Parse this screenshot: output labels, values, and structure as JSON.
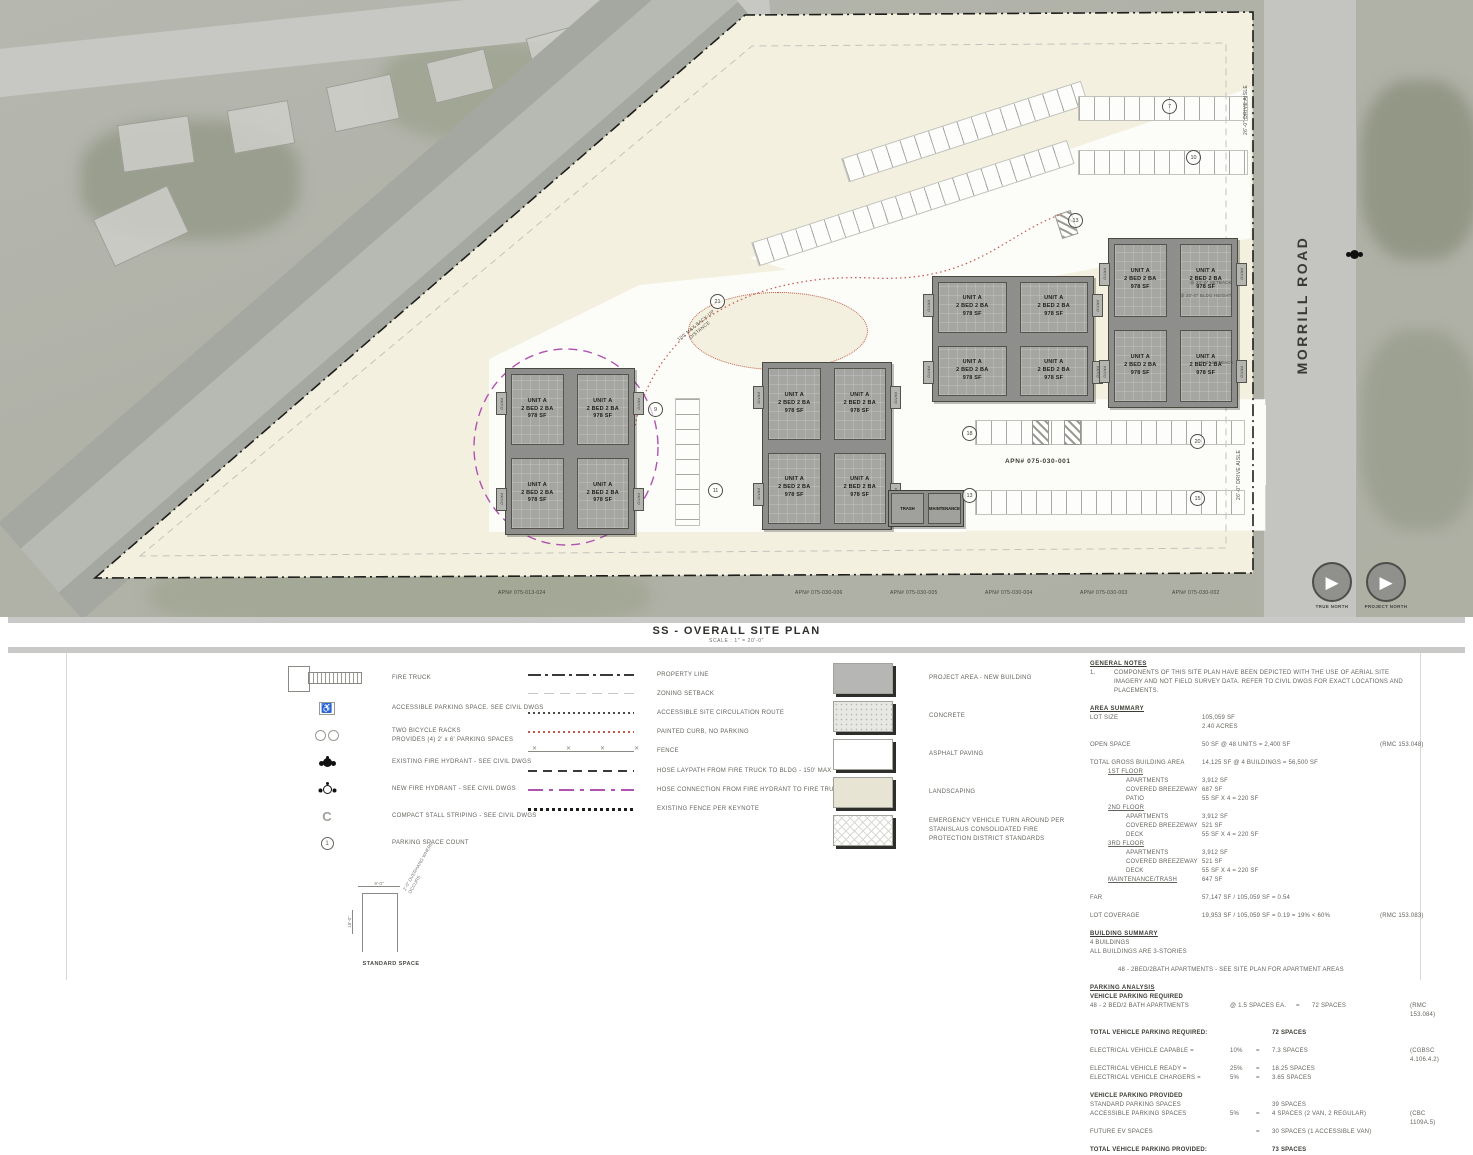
{
  "title": {
    "main": "SS - OVERALL SITE PLAN",
    "scale": "SCALE : 1\" = 20'-0\""
  },
  "plan": {
    "road": "MORRILL ROAD",
    "apn_site": "APN# 075-030-001",
    "apn_parcels": [
      "APN# 075-013-024",
      "APN# 075-030-006",
      "APN# 075-030-005",
      "APN# 075-030-004",
      "APN# 075-030-003",
      "APN# 075-030-002"
    ],
    "units4": [
      {
        "l1": "UNIT A",
        "l2": "2 BED 2 BA",
        "l3": "978 SF"
      },
      {
        "l1": "UNIT A",
        "l2": "2 BED 2 BA",
        "l3": "978 SF"
      },
      {
        "l1": "UNIT A",
        "l2": "2 BED 2 BA",
        "l3": "978 SF"
      },
      {
        "l1": "UNIT A",
        "l2": "2 BED 2 BA",
        "l3": "978 SF"
      }
    ],
    "patio": "PATIO",
    "trash": "TRASH",
    "maintenance": "MAINTENANCE",
    "backup_note": "100' MAX BACK-UP DISTANCE",
    "drive_aisle": "26'-0\" DRIVE AISLE",
    "setback_20": "@ 20'-0\" SETBACK",
    "bldg_height": "@ 20'-0\" BLDG HEIGHT",
    "setback_15": "15'-0\" SETBACK",
    "badges": [
      "7",
      "10",
      "13",
      "21",
      "9",
      "11",
      "18",
      "13",
      "20",
      "15"
    ],
    "north_true": "TRUE NORTH",
    "north_project": "PROJECT NORTH"
  },
  "legend_symbols": [
    {
      "cls": "sym-truck",
      "label": "FIRE TRUCK",
      "label2": ""
    },
    {
      "cls": "sym-ada",
      "label": "ACCESSIBLE PARKING SPACE. SEE CIVIL DWGS",
      "label2": ""
    },
    {
      "cls": "sym-bike",
      "label": "TWO BICYCLE RACKS",
      "label2": "PROVIDES (4) 2' x 6' PARKING SPACES"
    },
    {
      "cls": "sym-hyd-e",
      "label": "EXISTING FIRE HYDRANT - SEE CIVIL DWGS",
      "label2": ""
    },
    {
      "cls": "sym-hyd-n",
      "label": "NEW FIRE HYDRANT - SEE CIVIL DWGS",
      "label2": ""
    },
    {
      "cls": "sym-compact",
      "label": "COMPACT STALL STRIPING - SEE CIVIL DWGS",
      "label2": ""
    },
    {
      "cls": "sym-count",
      "label": "PARKING SPACE COUNT",
      "label2": ""
    }
  ],
  "standard_space": {
    "width": "9'-0\"",
    "depth": "18'-0\"",
    "note": "2'-0\" OVERHANG WHERE OCCURS",
    "label": "STANDARD SPACE"
  },
  "legend_lines": [
    {
      "cls": "ln-property",
      "label": "PROPERTY LINE"
    },
    {
      "cls": "ln-setback",
      "label": "ZONING SETBACK"
    },
    {
      "cls": "ln-route",
      "label": "ACCESSIBLE SITE CIRCULATION ROUTE"
    },
    {
      "cls": "ln-curb",
      "label": "PAINTED CURB, NO PARKING"
    },
    {
      "cls": "ln-fence",
      "label": "FENCE"
    },
    {
      "cls": "ln-laypath",
      "label": "HOSE LAYPATH FROM FIRE TRUCK TO BLDG - 150' MAX"
    },
    {
      "cls": "ln-hose",
      "label": "HOSE CONNECTION FROM FIRE HYDRANT TO FIRE TRUCK - 600' MAX"
    },
    {
      "cls": "ln-exfence",
      "label": "EXISTING FENCE PER KEYNOTE"
    }
  ],
  "legend_hatches": [
    {
      "cls": "sw-building",
      "label": "PROJECT AREA - NEW BUILDING"
    },
    {
      "cls": "sw-concrete",
      "label": "CONCRETE"
    },
    {
      "cls": "sw-asphalt",
      "label": "ASPHALT PAVING"
    },
    {
      "cls": "sw-landscape",
      "label": "LANDSCAPING"
    },
    {
      "cls": "sw-evta",
      "label": "EMERGENCY VEHICLE TURN AROUND PER STANISLAUS CONSOLIDATED FIRE PROTECTION DISTRICT STANDARDS"
    }
  ],
  "general_notes": {
    "heading": "GENERAL NOTES",
    "num": "1.",
    "text": "COMPONENTS OF THIS SITE PLAN HAVE BEEN DEPICTED WITH THE USE OF AERIAL SITE IMAGERY AND NOT FIELD SURVEY DATA. REFER TO CIVIL DWGS FOR EXACT LOCATIONS AND PLACEMENTS."
  },
  "area_summary": {
    "heading": "AREA SUMMARY",
    "rows": [
      {
        "label": "LOT SIZE",
        "value": "105,059 SF",
        "value2": "2.40 ACRES",
        "code": "",
        "cls": ""
      },
      {
        "label": "OPEN SPACE",
        "value": "50 SF @ 48 UNITS = 2,400 SF",
        "value2": "",
        "code": "(RMC 153.048)",
        "cls": "r-gap"
      },
      {
        "label": "TOTAL GROSS BUILDING AREA",
        "value": "14,125 SF @ 4 BUILDINGS = 56,500 SF",
        "value2": "",
        "code": "",
        "cls": "r-gap"
      },
      {
        "label": "1ST FLOOR",
        "value": "",
        "value2": "",
        "code": "",
        "cls": "r-sub"
      },
      {
        "label": "APARTMENTS",
        "value": "3,912 SF",
        "value2": "",
        "code": "",
        "cls": "r-item"
      },
      {
        "label": "COVERED BREEZEWAY",
        "value": "687 SF",
        "value2": "",
        "code": "",
        "cls": "r-item"
      },
      {
        "label": "PATIO",
        "value": "55 SF X 4 = 220 SF",
        "value2": "",
        "code": "",
        "cls": "r-item"
      },
      {
        "label": "2ND FLOOR",
        "value": "",
        "value2": "",
        "code": "",
        "cls": "r-sub"
      },
      {
        "label": "APARTMENTS",
        "value": "3,912 SF",
        "value2": "",
        "code": "",
        "cls": "r-item"
      },
      {
        "label": "COVERED BREEZEWAY",
        "value": "521 SF",
        "value2": "",
        "code": "",
        "cls": "r-item"
      },
      {
        "label": "DECK",
        "value": "55 SF X 4 = 220 SF",
        "value2": "",
        "code": "",
        "cls": "r-item"
      },
      {
        "label": "3RD FLOOR",
        "value": "",
        "value2": "",
        "code": "",
        "cls": "r-sub"
      },
      {
        "label": "APARTMENTS",
        "value": "3,912 SF",
        "value2": "",
        "code": "",
        "cls": "r-item"
      },
      {
        "label": "COVERED BREEZEWAY",
        "value": "521 SF",
        "value2": "",
        "code": "",
        "cls": "r-item"
      },
      {
        "label": "DECK",
        "value": "55 SF X 4 = 220 SF",
        "value2": "",
        "code": "",
        "cls": "r-item"
      },
      {
        "label": "MAINTENANCE/TRASH",
        "value": "647 SF",
        "value2": "",
        "code": "",
        "cls": "r-sub-u"
      },
      {
        "label": "FAR",
        "value": "57,147 SF / 105,059 SF = 0.54",
        "value2": "",
        "code": "",
        "cls": "r-gap"
      },
      {
        "label": "LOT COVERAGE",
        "value": "19,953 SF / 105,059 SF = 0.19 = 19% < 60%",
        "value2": "",
        "code": "(RMC 153.083)",
        "cls": "r-gap"
      }
    ]
  },
  "building_summary": {
    "heading": "BUILDING SUMMARY",
    "line1": "4 BUILDINGS",
    "line2": "ALL BUILDINGS ARE 3-STORIES",
    "callout": "48 - 2BED/2BATH APARTMENTS - SEE SITE PLAN FOR APARTMENT AREAS"
  },
  "parking": {
    "heading": "PARKING ANALYSIS",
    "sub_required": "VEHICLE PARKING REQUIRED",
    "rows_required": [
      {
        "label": "48 - 2 BED/2 BATH APARTMENTS",
        "rate": "@ 1.5 SPACES EA.",
        "eq": "=",
        "value": "72 SPACES",
        "code": "(RMC 153.084)"
      }
    ],
    "total_required_label": "TOTAL VEHICLE PARKING REQUIRED:",
    "total_required": "72 SPACES",
    "rows_ev": [
      {
        "label": "ELECTRICAL VEHICLE CAPABLE =",
        "rate": "10%",
        "eq": "=",
        "value": "7.3 SPACES",
        "code": "(CGBSC 4.106.4.2)"
      },
      {
        "label": "ELECTRICAL VEHICLE READY =",
        "rate": "25%",
        "eq": "=",
        "value": "18.25 SPACES",
        "code": ""
      },
      {
        "label": "ELECTRICAL VEHICLE CHARGERS =",
        "rate": "5%",
        "eq": "=",
        "value": "3.65 SPACES",
        "code": ""
      }
    ],
    "sub_provided": "VEHICLE PARKING PROVIDED",
    "rows_provided": [
      {
        "label": "STANDARD PARKING SPACES",
        "rate": "",
        "eq": "",
        "value": "39  SPACES",
        "code": ""
      },
      {
        "label": "ACCESSIBLE PARKING SPACES",
        "rate": "5%",
        "eq": "=",
        "value": "4 SPACES (2 VAN, 2 REGULAR)",
        "code": "(CBC 1109A.5)"
      },
      {
        "label": "FUTURE EV SPACES",
        "rate": "",
        "eq": "=",
        "value": "30 SPACES (1 ACCESSIBLE VAN)",
        "code": ""
      }
    ],
    "total_provided_label": "TOTAL VEHICLE PARKING PROVIDED:",
    "total_provided": "73 SPACES"
  }
}
